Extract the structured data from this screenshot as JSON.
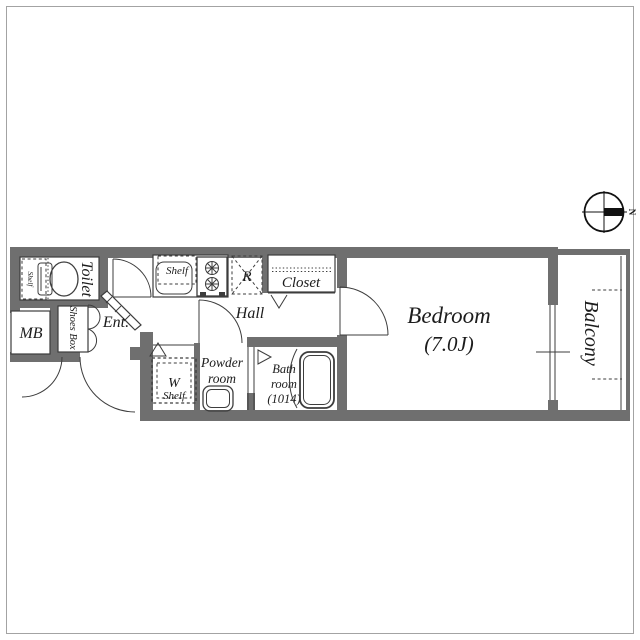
{
  "colors": {
    "wall": "#6f6f6f",
    "line": "#3d3d3d",
    "text": "#1c1c1c",
    "border": "#a3a3a3"
  },
  "compass": {
    "north_label": "N"
  },
  "rooms": {
    "toilet": {
      "label": "Toilet",
      "shelf_label": "Shelf"
    },
    "mb": {
      "label": "MB"
    },
    "shoes_box": {
      "label": "Shoes Box"
    },
    "entrance": {
      "label": "Ent."
    },
    "kitchen": {
      "shelf_label": "Shelf",
      "refrigerator_label": "R"
    },
    "closet": {
      "label": "Closet"
    },
    "hall": {
      "label": "Hall"
    },
    "washer": {
      "label": "W",
      "sub_label": "Shelf"
    },
    "powder": {
      "line1": "Powder",
      "line2": "room"
    },
    "bath": {
      "line1": "Bath",
      "line2": "room",
      "line3": "(1014)"
    },
    "bedroom": {
      "label": "Bedroom",
      "size": "(7.0J)"
    },
    "balcony": {
      "label": "Balcony"
    }
  }
}
